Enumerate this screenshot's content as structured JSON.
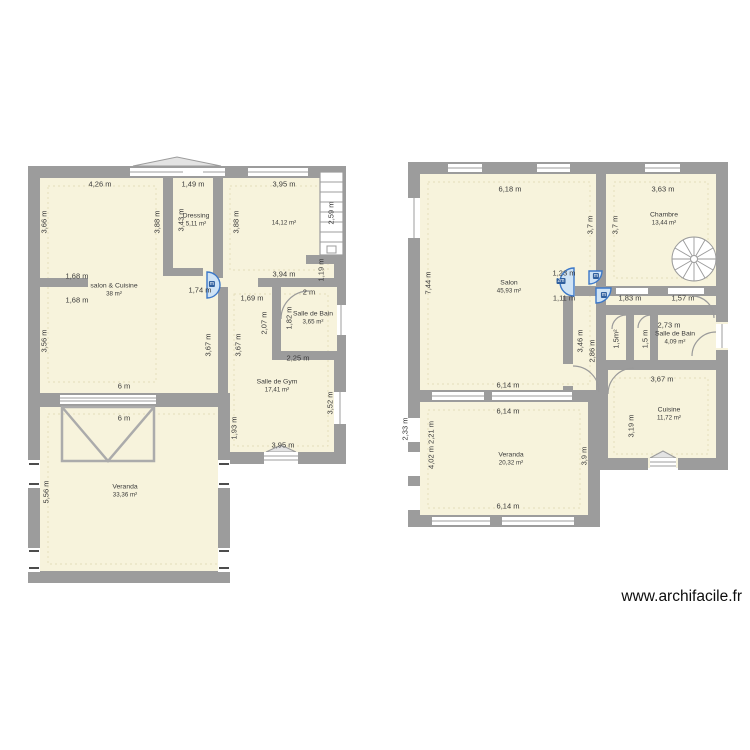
{
  "watermark": "www.archifacile.fr",
  "colors": {
    "room_fill": "#f7f3dc",
    "wall": "#9c9c9c",
    "door_blue": "#3c78c8",
    "door_blue_fill": "#cfe3f5",
    "dim_text": "#3a3a3a"
  },
  "plans": [
    {
      "name": "ground-floor-plan",
      "rooms": [
        {
          "name": "salon & Cuisine",
          "area": "38 m²",
          "x": 114,
          "y": 290
        },
        {
          "name": "Dressing",
          "area": "5,11 m²",
          "x": 196,
          "y": 220
        },
        {
          "name": "",
          "area": "14,12 m²",
          "x": 284,
          "y": 223
        },
        {
          "name": "Salle de Bain",
          "area": "3,65 m²",
          "x": 313,
          "y": 318
        },
        {
          "name": "Salle de Gym",
          "area": "17,41 m²",
          "x": 277,
          "y": 386
        },
        {
          "name": "Veranda",
          "area": "33,36 m²",
          "x": 125,
          "y": 491
        }
      ],
      "dimensions": [
        {
          "t": "4,26 m",
          "x": 100,
          "y": 184
        },
        {
          "t": "1,49 m",
          "x": 193,
          "y": 184
        },
        {
          "t": "3,95 m",
          "x": 284,
          "y": 184
        },
        {
          "t": "3,66 m",
          "x": 44,
          "y": 222,
          "v": 1
        },
        {
          "t": "3,88 m",
          "x": 157,
          "y": 222,
          "v": 1
        },
        {
          "t": "3,43 m",
          "x": 181,
          "y": 220,
          "v": 1
        },
        {
          "t": "3,88 m",
          "x": 236,
          "y": 222,
          "v": 1
        },
        {
          "t": "2,59 m",
          "x": 331,
          "y": 213,
          "v": 1
        },
        {
          "t": "1,68 m",
          "x": 77,
          "y": 276
        },
        {
          "t": "1,68 m",
          "x": 77,
          "y": 300
        },
        {
          "t": "1,74 m",
          "x": 200,
          "y": 290
        },
        {
          "t": "3,94 m",
          "x": 284,
          "y": 274
        },
        {
          "t": "1,19 m",
          "x": 321,
          "y": 270,
          "v": 1
        },
        {
          "t": "1,69 m",
          "x": 252,
          "y": 298
        },
        {
          "t": "2 m",
          "x": 309,
          "y": 292
        },
        {
          "t": "2,07 m",
          "x": 264,
          "y": 323,
          "v": 1
        },
        {
          "t": "1,82 m",
          "x": 289,
          "y": 318,
          "v": 1
        },
        {
          "t": "3,56 m",
          "x": 44,
          "y": 341,
          "v": 1
        },
        {
          "t": "3,67 m",
          "x": 208,
          "y": 345,
          "v": 1
        },
        {
          "t": "3,67 m",
          "x": 238,
          "y": 345,
          "v": 1
        },
        {
          "t": "2,25 m",
          "x": 298,
          "y": 358
        },
        {
          "t": "6 m",
          "x": 124,
          "y": 386
        },
        {
          "t": "6 m",
          "x": 124,
          "y": 418
        },
        {
          "t": "1,93 m",
          "x": 234,
          "y": 428,
          "v": 1
        },
        {
          "t": "3,52 m",
          "x": 330,
          "y": 403,
          "v": 1
        },
        {
          "t": "3,95 m",
          "x": 283,
          "y": 445
        },
        {
          "t": "5,56 m",
          "x": 46,
          "y": 492,
          "v": 1
        }
      ],
      "door_tags": [
        {
          "t": "m",
          "x": 212,
          "y": 284
        }
      ]
    },
    {
      "name": "upper-floor-plan",
      "rooms": [
        {
          "name": "Salon",
          "area": "45,93 m²",
          "x": 509,
          "y": 287
        },
        {
          "name": "Chambre",
          "area": "13,44 m²",
          "x": 664,
          "y": 219
        },
        {
          "name": "Salle de Bain",
          "area": "4,09 m²",
          "x": 675,
          "y": 338
        },
        {
          "name": "Cuisine",
          "area": "11,72 m²",
          "x": 669,
          "y": 414
        },
        {
          "name": "Veranda",
          "area": "20,32 m²",
          "x": 511,
          "y": 459
        }
      ],
      "dimensions": [
        {
          "t": "6,18 m",
          "x": 510,
          "y": 189
        },
        {
          "t": "3,63 m",
          "x": 663,
          "y": 189
        },
        {
          "t": "7,44 m",
          "x": 428,
          "y": 283,
          "v": 1
        },
        {
          "t": "3,7 m",
          "x": 590,
          "y": 225,
          "v": 1
        },
        {
          "t": "3,7 m",
          "x": 615,
          "y": 225,
          "v": 1
        },
        {
          "t": "1,23 m",
          "x": 564,
          "y": 273
        },
        {
          "t": "1,11 m",
          "x": 564,
          "y": 298
        },
        {
          "t": "1,83 m",
          "x": 630,
          "y": 298
        },
        {
          "t": "1,57 m",
          "x": 683,
          "y": 298
        },
        {
          "t": "2,73 m",
          "x": 669,
          "y": 325
        },
        {
          "t": "3,46 m",
          "x": 580,
          "y": 341,
          "v": 1
        },
        {
          "t": "2,86 m",
          "x": 592,
          "y": 351,
          "v": 1
        },
        {
          "t": "1,5m²",
          "x": 616,
          "y": 339,
          "v": 1
        },
        {
          "t": "1,5 m",
          "x": 645,
          "y": 339,
          "v": 1
        },
        {
          "t": "3,67 m",
          "x": 662,
          "y": 379
        },
        {
          "t": "6,14 m",
          "x": 508,
          "y": 385
        },
        {
          "t": "6,14 m",
          "x": 508,
          "y": 411
        },
        {
          "t": "6,14 m",
          "x": 508,
          "y": 506
        },
        {
          "t": "2,33 m",
          "x": 405,
          "y": 429,
          "v": 1
        },
        {
          "t": "4,02 m 2,21 m",
          "x": 431,
          "y": 445,
          "v": 1
        },
        {
          "t": "3,9 m",
          "x": 584,
          "y": 456,
          "v": 1
        },
        {
          "t": "3,19 m",
          "x": 631,
          "y": 426,
          "v": 1
        }
      ],
      "door_tags": [
        {
          "t": "2m",
          "x": 561,
          "y": 281
        },
        {
          "t": "m",
          "x": 596,
          "y": 276
        },
        {
          "t": "m",
          "x": 604,
          "y": 295
        }
      ]
    }
  ]
}
